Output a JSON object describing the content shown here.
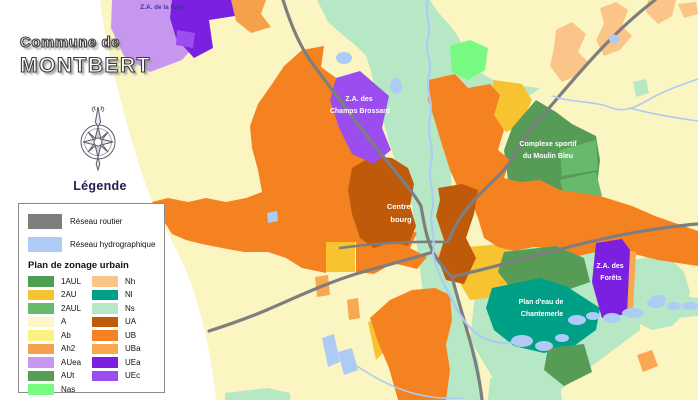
{
  "panel": {
    "title_line1": "Commune de",
    "title_line2": "MONTBERT",
    "legend_heading": "Légende",
    "legend": {
      "roads_label": "Réseau routier",
      "hydro_label": "Réseau hydrographique",
      "zoning_heading": "Plan de zonage urbain",
      "zones_left": [
        "1AUL",
        "2AU",
        "2AUL",
        "A",
        "Ab",
        "Ah2",
        "AUea",
        "AUt",
        "Nas"
      ],
      "zones_right": [
        "Nh",
        "Nl",
        "Ns",
        "UA",
        "UB",
        "UBa",
        "UEa",
        "UEc"
      ]
    }
  },
  "colors": {
    "road": "#7E7E7E",
    "hydro": "#AECBF5",
    "map_background": "#FBF5C1",
    "zones": {
      "1AUL": "#4F9D51",
      "2AU": "#F7C331",
      "2AUL": "#69B96D",
      "A": "#FCF6C8",
      "Ab": "#FDF083",
      "Ah2": "#F5A14B",
      "AUea": "#C796EF",
      "AUt": "#569C57",
      "Nas": "#77FB80",
      "Nh": "#FBC489",
      "Nl": "#00A086",
      "Ns": "#B7E8C6",
      "UA": "#C05A0B",
      "UB": "#F58220",
      "UBa": "#F9A750",
      "UEa": "#7B1FE0",
      "UEc": "#9B4DF0"
    }
  },
  "map": {
    "labels": {
      "raye": "Z.A. de la Raye",
      "brossard_l1": "Z.A. des",
      "brossard_l2": "Champs Brossard",
      "bourg_l1": "Centre-",
      "bourg_l2": "bourg",
      "moulin_l1": "Complexe sportif",
      "moulin_l2": "du Moulin Bleu",
      "forets_l1": "Z.A. des",
      "forets_l2": "Forêts",
      "plandeau_l1": "Plan d'eau de",
      "plandeau_l2": "Chantemerle"
    }
  }
}
